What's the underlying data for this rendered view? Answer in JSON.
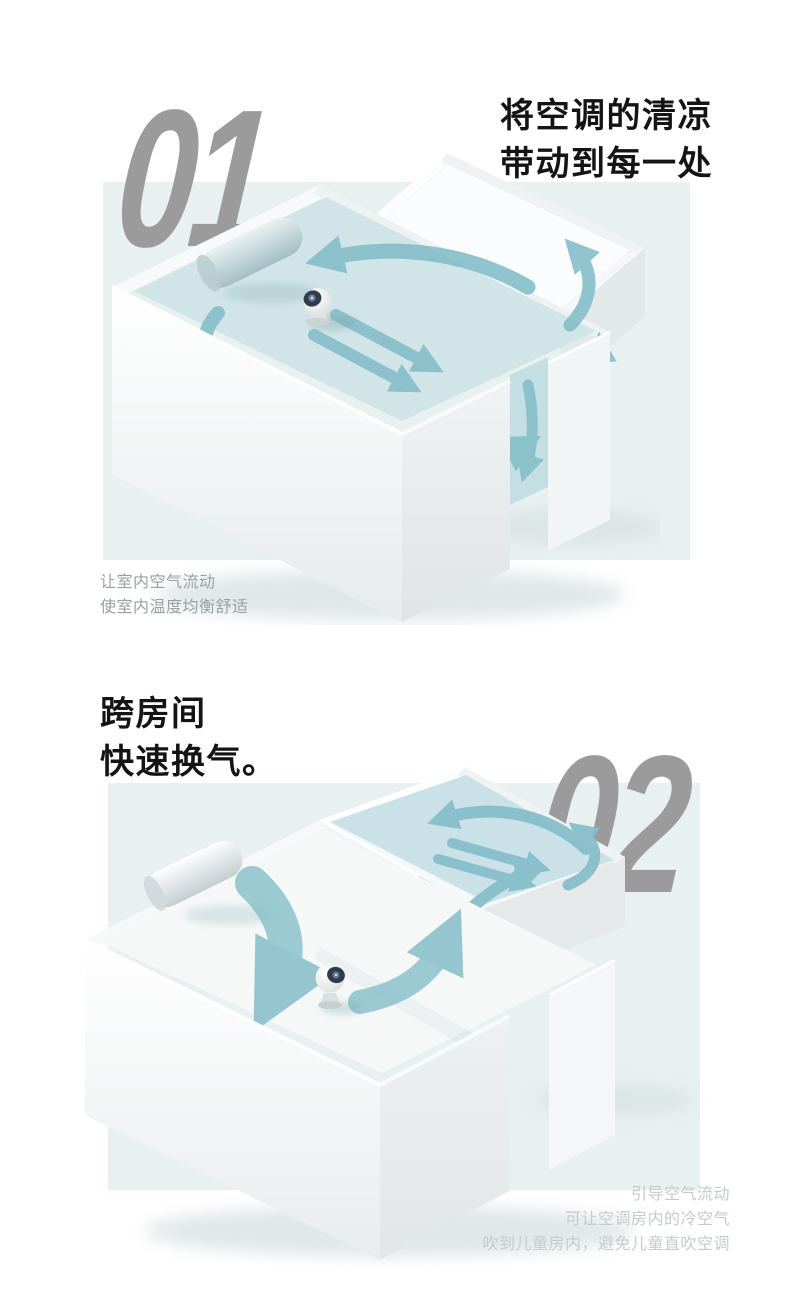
{
  "colors": {
    "background": "#ffffff",
    "panel": "#e9f1f0",
    "number_gray": "#9b9b9b",
    "heading_black": "#141414",
    "caption_gray": "#9aa0a0",
    "caption_light_gray": "#c6cbca",
    "airflow_teal": "#85bec9",
    "air_sheet_blue": "#cfe4e7"
  },
  "section1": {
    "number": "01",
    "heading": [
      "将空调的清凉",
      "带动到每一处"
    ],
    "caption": [
      "让室内空气流动",
      "使室内温度均衡舒适"
    ],
    "illustration_alt": "isometric-room-with-circulating-airflow"
  },
  "section2": {
    "number": "02",
    "heading": [
      "跨房间",
      "快速换气。"
    ],
    "caption": [
      "引导空气流动",
      "可让空调房内的冷空气",
      "吹到儿童房内，避免儿童直吹空调"
    ],
    "illustration_alt": "isometric-two-rooms-cross-ventilation"
  }
}
